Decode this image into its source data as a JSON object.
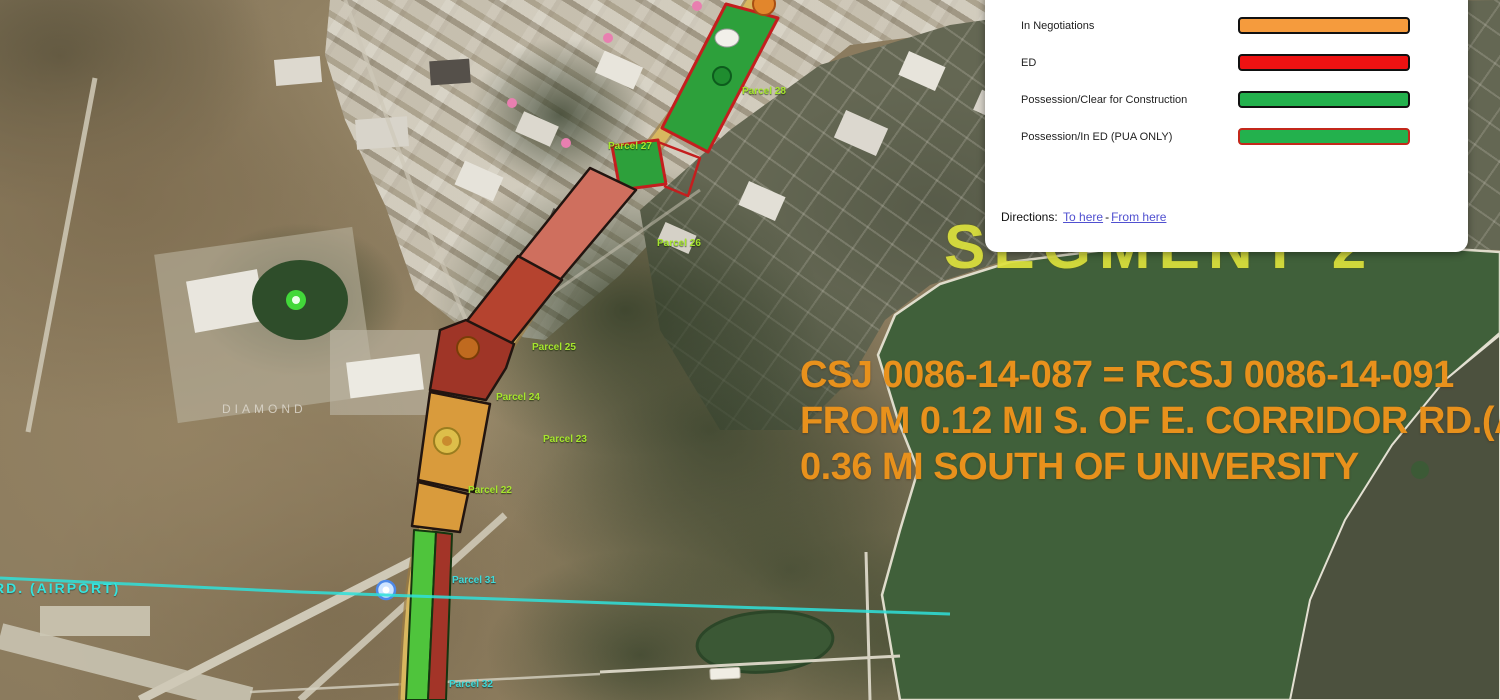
{
  "legend": {
    "items": [
      {
        "label": "In Negotiations",
        "fill": "#F59B3D",
        "border": "#111111"
      },
      {
        "label": "ED",
        "fill": "#EE1212",
        "border": "#111111"
      },
      {
        "label": "Possession/Clear for Construction",
        "fill": "#23B14D",
        "border": "#111111"
      },
      {
        "label": "Possession/In ED (PUA ONLY)",
        "fill": "#23B14D",
        "border": "#C3281B"
      }
    ],
    "directions_label": "Directions:",
    "to_here": "To here",
    "separator": "-",
    "from_here": "From here"
  },
  "map_overlay": {
    "project_note": {
      "line1": "CSJ 0086-14-087 = RCSJ 0086-14-091",
      "line2": "FROM 0.12 MI S. OF E. CORRIDOR RD.(A",
      "line3": "0.36 MI SOUTH OF UNIVERSITY",
      "color": "#E8911C"
    },
    "segment_label": {
      "text": "SEGMENT 2",
      "color": "#DDE23C"
    },
    "airport_road_label": {
      "text": "RD. (AIRPORT)",
      "color": "#35E3DE"
    },
    "place_label": {
      "text": "DIAMOND"
    },
    "parcel_labels": [
      {
        "text": "Parcel 28",
        "color": "green"
      },
      {
        "text": "Parcel 27",
        "color": "green"
      },
      {
        "text": "Parcel 26",
        "color": "green"
      },
      {
        "text": "Parcel 25",
        "color": "green"
      },
      {
        "text": "Parcel 24",
        "color": "green"
      },
      {
        "text": "Parcel 23",
        "color": "green"
      },
      {
        "text": "Parcel 22",
        "color": "green"
      },
      {
        "text": "Parcel 31",
        "color": "cyan"
      },
      {
        "text": "Parcel 32",
        "color": "cyan"
      }
    ],
    "status_colors": {
      "in_negotiations": "#D99B3C",
      "ed": "#B5432F",
      "possession_clear": "#2DA03B",
      "possession_in_ed_border": "#C41E1E"
    }
  }
}
